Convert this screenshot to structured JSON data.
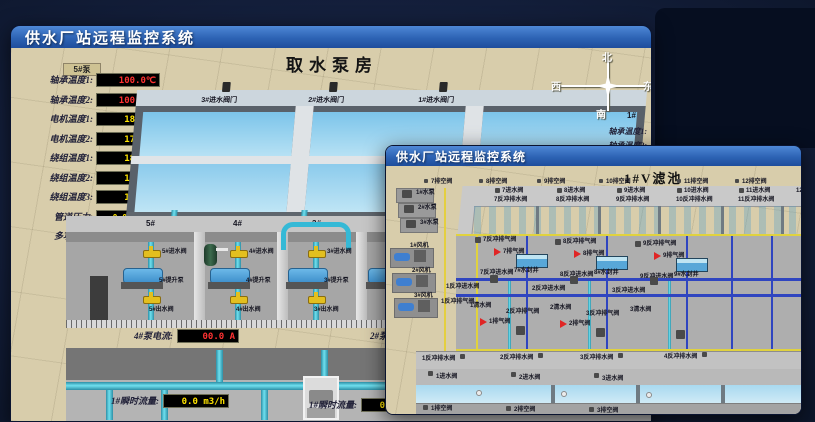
{
  "colors": {
    "titlebar_blue": "#2d63b4",
    "value_red": "#ff3232",
    "value_yellow": "#ffe400",
    "pipe_cyan": "#6fe0ef",
    "valve_yellow": "#e3bf1f",
    "pump_blue": "#4da0dc",
    "water_blue": "#bfe3f2",
    "air_valve_red": "#e02525"
  },
  "back": {
    "title": "供水厂站远程监控系统",
    "scene_title": "取水泵房",
    "panel": {
      "header": "5#泵",
      "readouts": [
        {
          "label": "轴承温度1:",
          "value": "100.0℃"
        },
        {
          "label": "轴承温度2:",
          "value": "100.0℃"
        },
        {
          "label": "电机温度1:",
          "value": "18.1℃"
        },
        {
          "label": "电机温度2:",
          "value": "17.9℃"
        },
        {
          "label": "绕组温度1:",
          "value": "18.0℃"
        },
        {
          "label": "绕组温度2:",
          "value": "18.1℃"
        },
        {
          "label": "绕组温度3:",
          "value": "18.1℃"
        },
        {
          "label": "管道压力:",
          "value": "0.0007MPa"
        },
        {
          "label": "多功能阀:",
          "value": "0%"
        }
      ]
    },
    "inlet_valves": [
      "3#进水阀门",
      "2#进水阀门",
      "1#进水阀门"
    ],
    "compass": {
      "n": "北",
      "w": "西",
      "s": "南",
      "e": "东"
    },
    "side": {
      "tag": "1#",
      "rows": [
        "轴承温度1:",
        "轴承温度2:"
      ]
    },
    "cells": [
      {
        "num": "5#",
        "inlet": "5#进水阀",
        "pump": "5#提升泵",
        "outlet": "5#出水阀"
      },
      {
        "num": "4#",
        "inlet": "4#进水阀",
        "pump": "4#提升泵",
        "outlet": "4#出水阀"
      },
      {
        "num": "3#",
        "inlet": "3#进水阀",
        "pump": "3#提升泵",
        "outlet": "3#出水阀"
      }
    ],
    "current": [
      {
        "label": "4#泵电流:",
        "value": "00.0 A"
      },
      {
        "label": "2#泵电流:",
        "value": ""
      }
    ],
    "flows": [
      {
        "label": "1#瞬时流量:",
        "value": "0.0 m3/h"
      },
      {
        "label": "1#瞬时流量:",
        "value": "0.0 m3/h"
      }
    ]
  },
  "front": {
    "title": "供水厂站远程监控系统",
    "scene_title": "1#V滤池",
    "vents_top": [
      "7排空阀",
      "8排空阀",
      "9排空阀",
      "10排空阀",
      "11排空阀",
      "12排空阀"
    ],
    "upper_inlets": [
      "7进水阀",
      "8进水阀",
      "9进水阀",
      "10进水阀",
      "11进水阀",
      "12进水阀"
    ],
    "upper_drains": [
      "7反冲排水阀",
      "8反冲排水阀",
      "9反冲排水阀",
      "10反冲排水阀",
      "11反冲排水阀"
    ],
    "corridor": {
      "bw_air": [
        "7反冲排气阀",
        "8反冲排气阀",
        "9反冲排气阀"
      ],
      "air": [
        "7排气阀",
        "8排气阀",
        "9排气阀"
      ],
      "wells": [
        "7#水封井",
        "8#水封井",
        "9#水封井"
      ],
      "bw_inlet": [
        "7反冲进水阀",
        "8反冲进水阀",
        "9反冲进水阀"
      ],
      "bw_inlet2": [
        "2反冲进水阀",
        "3反冲进水阀"
      ],
      "clean": [
        "1清水阀",
        "2清水阀",
        "3清水阀"
      ],
      "bw_air2": [
        "2反冲排气阀",
        "3反冲排气阀"
      ],
      "air2": [
        "1排气阀",
        "2排气阀"
      ],
      "cell1_bw_inlet": "1反冲进水阀",
      "cell1_bw_air": "1反冲排气阀"
    },
    "lower_drains": [
      "1反冲排水阀",
      "2反冲排水阀",
      "3反冲排水阀",
      "4反冲排水阀"
    ],
    "lower_inlets": [
      "1进水阀",
      "2进水阀",
      "3进水阀"
    ],
    "lower_vents": [
      "1排空阀",
      "2排空阀",
      "3排空阀"
    ],
    "equipment": [
      "1#水泵",
      "2#水泵",
      "3#水泵",
      "1#风机",
      "2#风机",
      "3#风机"
    ]
  }
}
